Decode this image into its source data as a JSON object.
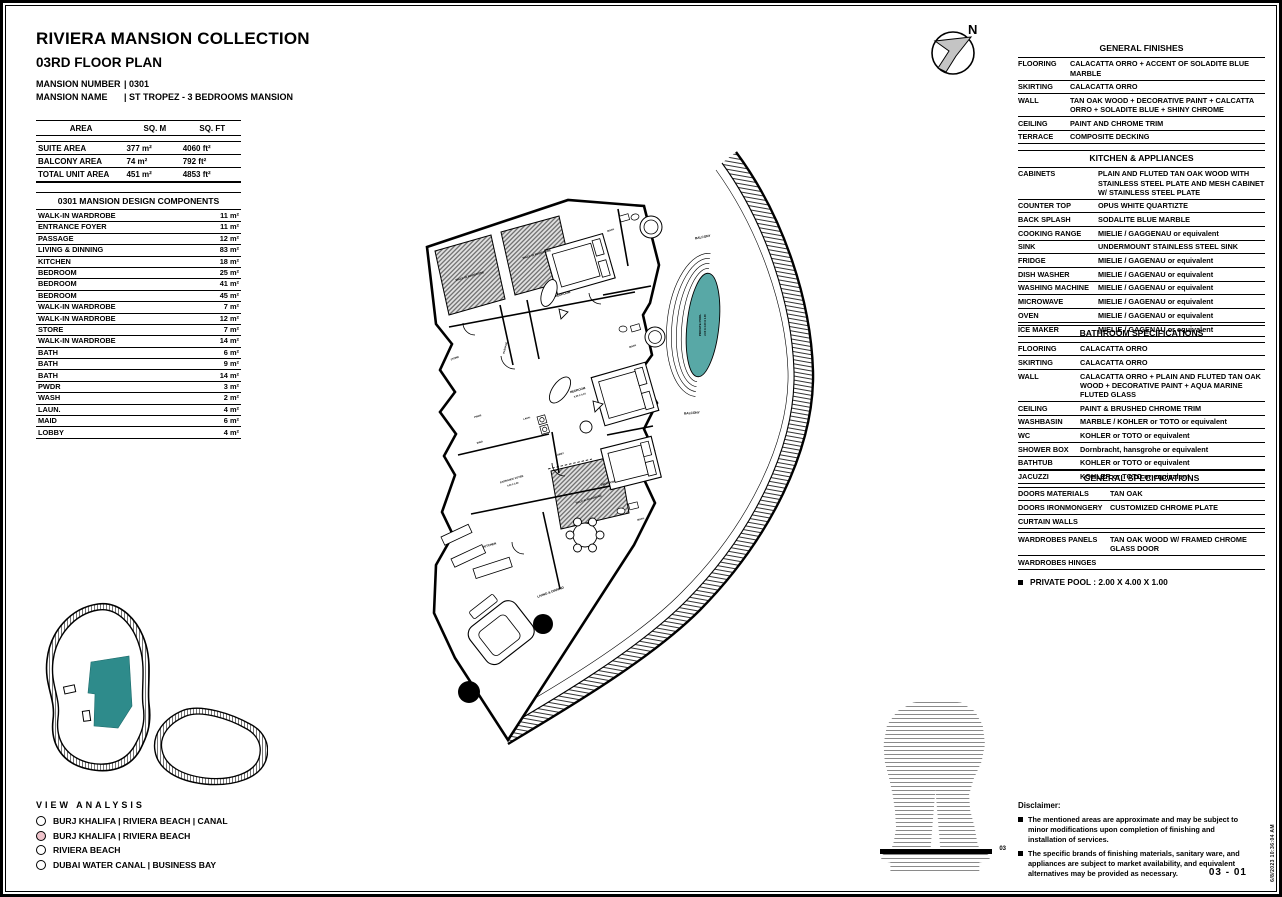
{
  "header": {
    "title": "RIVIERA MANSION COLLECTION",
    "subtitle": "03RD FLOOR PLAN",
    "number_label": "MANSION NUMBER",
    "number_value": "| 0301",
    "name_label": "MANSION NAME",
    "name_value": "| ST TROPEZ - 3 BEDROOMS MANSION"
  },
  "area_table": {
    "headers": [
      "AREA",
      "SQ. M",
      "SQ. FT"
    ],
    "rows": [
      {
        "name": "SUITE AREA",
        "sqm": "377 m²",
        "sqft": "4060 ft²"
      },
      {
        "name": "BALCONY AREA",
        "sqm": "74 m²",
        "sqft": "792 ft²"
      },
      {
        "name": "TOTAL UNIT AREA",
        "sqm": "451 m²",
        "sqft": "4853 ft²"
      }
    ]
  },
  "components_table": {
    "title": "0301 MANSION DESIGN COMPONENTS",
    "rows": [
      {
        "name": "WALK-IN WARDROBE",
        "area": "11 m²"
      },
      {
        "name": "ENTRANCE FOYER",
        "area": "11 m²"
      },
      {
        "name": "PASSAGE",
        "area": "12 m²"
      },
      {
        "name": "LIVING & DINNING",
        "area": "83 m²"
      },
      {
        "name": "KITCHEN",
        "area": "18 m²"
      },
      {
        "name": "BEDROOM",
        "area": "25 m²"
      },
      {
        "name": "BEDROOM",
        "area": "41 m²"
      },
      {
        "name": "BEDROOM",
        "area": "45 m²"
      },
      {
        "name": "WALK-IN WARDROBE",
        "area": "7 m²"
      },
      {
        "name": "WALK-IN WARDROBE",
        "area": "12 m²"
      },
      {
        "name": "STORE",
        "area": "7 m²"
      },
      {
        "name": "WALK-IN WARDROBE",
        "area": "14 m²"
      },
      {
        "name": "BATH",
        "area": "6 m²"
      },
      {
        "name": "BATH",
        "area": "9 m²"
      },
      {
        "name": "BATH",
        "area": "14 m²"
      },
      {
        "name": "PWDR",
        "area": "3 m²"
      },
      {
        "name": "WASH",
        "area": "2 m²"
      },
      {
        "name": "LAUN.",
        "area": "4 m²"
      },
      {
        "name": "MAID",
        "area": "6 m²"
      },
      {
        "name": "LOBBY",
        "area": "4 m²"
      }
    ]
  },
  "view_analysis": {
    "title": "VIEW ANALYSIS",
    "options": [
      {
        "label": "BURJ KHALIFA | RIVIERA BEACH | CANAL",
        "selected": false
      },
      {
        "label": "BURJ KHALIFA | RIVIERA BEACH",
        "selected": true
      },
      {
        "label": "RIVIERA BEACH",
        "selected": false
      },
      {
        "label": "DUBAI WATER CANAL | BUSINESS BAY",
        "selected": false
      }
    ]
  },
  "finishes": {
    "title": "GENERAL FINISHES",
    "rows": [
      {
        "label": "FLOORING",
        "value": "CALACATTA ORRO + ACCENT OF SOLADITE BLUE MARBLE"
      },
      {
        "label": "SKIRTING",
        "value": "CALACATTA ORRO"
      },
      {
        "label": "WALL",
        "value": "TAN OAK WOOD + DECORATIVE PAINT + CALCATTA ORRO + SOLADITE BLUE + SHINY CHROME"
      },
      {
        "label": "CEILING",
        "value": "PAINT AND CHROME TRIM"
      },
      {
        "label": "TERRACE",
        "value": "COMPOSITE DECKING"
      }
    ]
  },
  "kitchen": {
    "title": "KITCHEN & APPLIANCES",
    "rows": [
      {
        "label": "CABINETS",
        "value": "PLAIN AND FLUTED TAN OAK WOOD WITH STAINLESS STEEL PLATE AND MESH CABINET W/ STAINLESS STEEL PLATE"
      },
      {
        "label": "COUNTER TOP",
        "value": "OPUS WHITE QUARTIZTE"
      },
      {
        "label": "BACK SPLASH",
        "value": "SODALITE BLUE MARBLE"
      },
      {
        "label": "COOKING RANGE",
        "value": "MIELIE / GAGGENAU or equivalent"
      },
      {
        "label": "SINK",
        "value": "UNDERMOUNT STAINLESS STEEL SINK"
      },
      {
        "label": "FRIDGE",
        "value": "MIELIE / GAGENAU or equivalent"
      },
      {
        "label": "DISH WASHER",
        "value": "MIELIE / GAGENAU or equivalent"
      },
      {
        "label": "WASHING MACHINE",
        "value": "MIELIE / GAGENAU or equivalent"
      },
      {
        "label": "MICROWAVE",
        "value": "MIELIE / GAGENAU or equivalent"
      },
      {
        "label": "OVEN",
        "value": "MIELIE / GAGENAU or equivalent"
      },
      {
        "label": "ICE MAKER",
        "value": "MIELIE / GAGENAU or equivalent"
      }
    ]
  },
  "bathroom": {
    "title": "BATHROOM SPECIFICATIONS",
    "rows": [
      {
        "label": "FLOORING",
        "value": "CALACATTA ORRO"
      },
      {
        "label": "SKIRTING",
        "value": "CALACATTA ORRO"
      },
      {
        "label": "WALL",
        "value": "CALACATTA ORRO + PLAIN AND FLUTED TAN OAK WOOD + DECORATIVE PAINT + AQUA MARINE FLUTED GLASS"
      },
      {
        "label": "CEILING",
        "value": "PAINT & BRUSHED CHROME TRIM"
      },
      {
        "label": "WASHBASIN",
        "value": "MARBLE / KOHLER or TOTO or equivalent"
      },
      {
        "label": "WC",
        "value": "KOHLER or TOTO or equivalent"
      },
      {
        "label": "SHOWER BOX",
        "value": "Dornbracht, hansgrohe or equivalent"
      },
      {
        "label": "BATHTUB",
        "value": "KOHLER or TOTO or equivalent"
      },
      {
        "label": "JACUZZI",
        "value": "KOHLER or TOTO or equivalent"
      }
    ]
  },
  "general_specs": {
    "title": "GENERAL SPECIFICATIONS",
    "rows": [
      {
        "label": "DOORS MATERIALS",
        "value": "TAN OAK"
      },
      {
        "label": "DOORS IRONMONGERY",
        "value": "CUSTOMIZED CHROME PLATE"
      },
      {
        "label": "CURTAIN WALLS",
        "value": ""
      },
      {
        "label": "",
        "value": ""
      },
      {
        "label": "WARDROBES PANELS",
        "value": "TAN OAK WOOD W/ FRAMED CHROME GLASS DOOR"
      },
      {
        "label": "WARDROBES HINGES",
        "value": ""
      }
    ]
  },
  "pool_note": "PRIVATE POOL :  2.00 X 4.00 X 1.00",
  "disclaimer": {
    "title": "Disclaimer:",
    "items": [
      "The mentioned areas are approximate and may be subject to minor modifications  upon completion of finishing and installation of services.",
      "The specific brands of finishing materials, sanitary ware, and appliances are subject to market availability, and equivalent alternatives may be provided as necessary."
    ]
  },
  "page_number": "03 - 01",
  "print_stamp": "6/8/2023 10:36:04 AM",
  "compass": {
    "label": "N"
  },
  "plan": {
    "wardrobe_label": "WALK-IN WARDROBE",
    "bedroom_label": "BEDROOM",
    "bedroom2_dim": "5.20 X 4.10",
    "bath_label": "BATH",
    "store_label": "STORE",
    "passage_label": "PASSAGE",
    "pwdr_label": "PWDR",
    "maid_label": "MAID",
    "laun_label": "LAUN.",
    "lobby_label": "LOBBY",
    "entrance_label": "ENTRANCE FOYER",
    "entrance_dim": "4.20 X 2.90",
    "kitchen_label": "KITCHEN",
    "living_label": "LIVING & DINNING",
    "balcony_label": "BALCONY",
    "pool_label_1": "PRIVATE POOL",
    "pool_label_2": "2.00 X 4.00 X 1.00",
    "tower_floor_label": "03"
  },
  "colors": {
    "pool_teal": "#58a8a6",
    "keyplan_teal": "#2e8b8b",
    "view_selected_pink": "#efc3cb",
    "compass_arrow_gray": "#c4c4c4"
  }
}
